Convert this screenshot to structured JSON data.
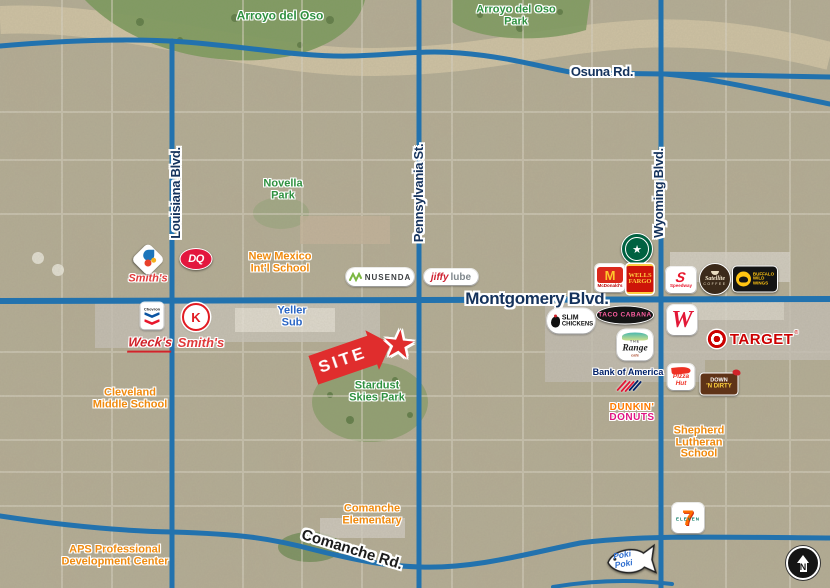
{
  "title": "Aerial site map — Montgomery Blvd & Pennsylvania St, Albuquerque",
  "colors": {
    "road_blue": "#2272ae",
    "street_label_navy": "#14325c",
    "park_green": "#2f9140",
    "school_orange": "#ef8a0e",
    "site_red": "#e02d2d"
  },
  "streets": {
    "osuna": "Osuna Rd.",
    "montgomery": "Montgomery Blvd.",
    "comanche": "Comanche Rd.",
    "louisiana": "Louisiana Blvd.",
    "pennsylvania": "Pennsylvania St.",
    "wyoming": "Wyoming Blvd."
  },
  "areas": {
    "arroyo": "Arroyo del Oso",
    "arroyo_park_1": "Arroyo del Oso",
    "arroyo_park_2": "Park",
    "novella_1": "Novella",
    "novella_2": "Park",
    "stardust_1": "Stardust",
    "stardust_2": "Skies Park"
  },
  "schools": {
    "nm_1": "New Mexico",
    "nm_2": "Int'l School",
    "cleveland_1": "Cleveland",
    "cleveland_2": "Middle School",
    "shepherd_1": "Shepherd",
    "shepherd_2": "Lutheran",
    "shepherd_3": "School",
    "comanche_1": "Comanche",
    "comanche_2": "Elementary",
    "aps_1": "APS Professional",
    "aps_2": "Development Center"
  },
  "site": {
    "label": "SITE"
  },
  "icons": {
    "star": "★"
  },
  "poi": {
    "yeller_1": "Yeller",
    "yeller_2": "Sub"
  },
  "logos": {
    "smiths": "Smith's",
    "dq": "DQ",
    "nusenda": "NUSENDA",
    "jiffy": "jiffy",
    "lube": "lube",
    "mcd_m": "M",
    "mcdonalds": "McDonald's",
    "wells_1": "WELLS",
    "wells_2": "FARGO",
    "speedway_s": "S",
    "speedway": "Speedway",
    "satellite": "Satellite",
    "satellite_coffee": "COFFEE",
    "bww_1": "BUFFALO",
    "bww_2": "WILD",
    "bww_3": "WINGS",
    "chevron": "Chevron",
    "circlek": "K",
    "wecks": "Weck's",
    "smiths2": "Smith's",
    "slim_1": "SLIM",
    "slim_2": "CHICKENS",
    "taco": "TACO CABANA",
    "walgreens_w": "W",
    "range_the": "THE",
    "range": "Range",
    "range_cafe": "café",
    "boa": "Bank of America",
    "dunkin_1": "DUNKIN'",
    "dunkin_2": "DONUTS",
    "target": "TARGET",
    "target_reg": "®",
    "pizza_1": "Pizza",
    "pizza_2": "Hut",
    "dnd_1": "DOWN",
    "dnd_2": "'N DIRTY",
    "seven": "7",
    "eleven": "ELEVEN",
    "poki_1": "Poki",
    "poki_2": "Poki"
  },
  "compass": {
    "north": "N"
  }
}
